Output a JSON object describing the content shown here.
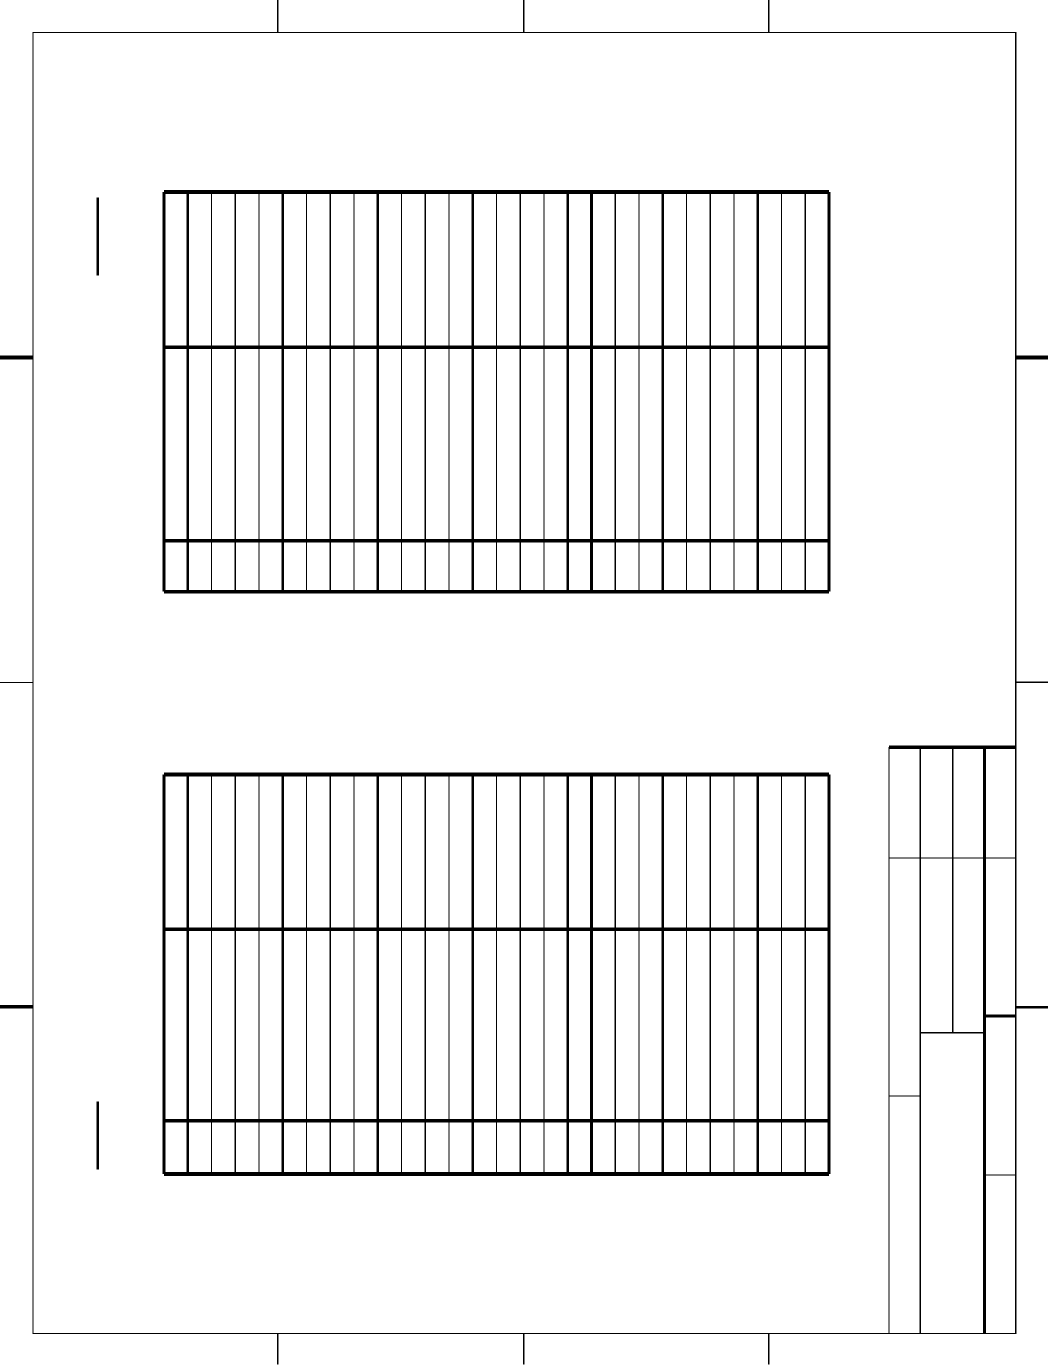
{
  "canvas": {
    "width": 1048,
    "height": 1367,
    "background": "#ffffff",
    "ink": "#000000"
  },
  "frame": {
    "x1": 33,
    "y1": 32.5,
    "x2": 1015.7,
    "y2": 1333.5,
    "stroke": 1.4,
    "tick_stroke": 1.4,
    "tick_len_top": 32.5,
    "tick_len_bottom": 31,
    "ticks_top_x": [
      277.7,
      523.7,
      768.7
    ],
    "ticks_bottom_x": [
      277.7,
      523.7,
      768.7
    ],
    "ticks_left": [
      {
        "y": 357.5,
        "w": 4
      },
      {
        "y": 682.5,
        "w": 1.3
      },
      {
        "y": 1006.7,
        "w": 3.5
      }
    ],
    "ticks_right": [
      {
        "y": 357.3,
        "w": 4
      },
      {
        "y": 682.3,
        "w": 1.3
      },
      {
        "y": 1007.3,
        "w": 2.4
      }
    ]
  },
  "stub_marks": [
    {
      "x": 97.7,
      "y1": 197.7,
      "y2": 275.7,
      "w": 2.2
    },
    {
      "x": 97.7,
      "y1": 1101.7,
      "y2": 1169.3,
      "w": 2.2
    }
  ],
  "grid_tables": {
    "x_left": 164,
    "x_right": 829,
    "column_count": 28,
    "column_width": 23.75,
    "thick_column_indices": [
      0,
      1,
      5,
      9,
      13,
      17,
      18,
      21,
      25,
      28
    ],
    "h_stroke": 3.8,
    "v_thick": 2.8,
    "v_thin": 1.3,
    "tables": [
      {
        "id": "upper-grid",
        "row_lines": [
          192,
          347.3,
          540.8,
          591.7
        ]
      },
      {
        "id": "lower-grid",
        "row_lines": [
          774.5,
          929.3,
          1120.7,
          1174
        ]
      }
    ]
  },
  "title_block": {
    "v_lines": [
      {
        "x": 889,
        "y1": 747,
        "y2": 1333.5,
        "w": 1.3
      },
      {
        "x": 920.3,
        "y1": 747,
        "y2": 1333.5,
        "w": 1.3
      },
      {
        "x": 952.7,
        "y1": 747,
        "y2": 1032.7,
        "w": 1.3
      },
      {
        "x": 984.3,
        "y1": 747,
        "y2": 1333.5,
        "w": 3
      }
    ],
    "h_lines": [
      {
        "y": 747,
        "x1": 889,
        "x2": 1015.7,
        "w": 3.5
      },
      {
        "y": 858,
        "x1": 889,
        "x2": 1015.7,
        "w": 1.3
      },
      {
        "y": 1016,
        "x1": 984.3,
        "x2": 1015.7,
        "w": 3
      },
      {
        "y": 1032.7,
        "x1": 920.3,
        "x2": 984.3,
        "w": 1.3
      },
      {
        "y": 1096,
        "x1": 889,
        "x2": 920.3,
        "w": 1.3
      },
      {
        "y": 1175,
        "x1": 984.3,
        "x2": 1015.7,
        "w": 1.3
      }
    ]
  }
}
